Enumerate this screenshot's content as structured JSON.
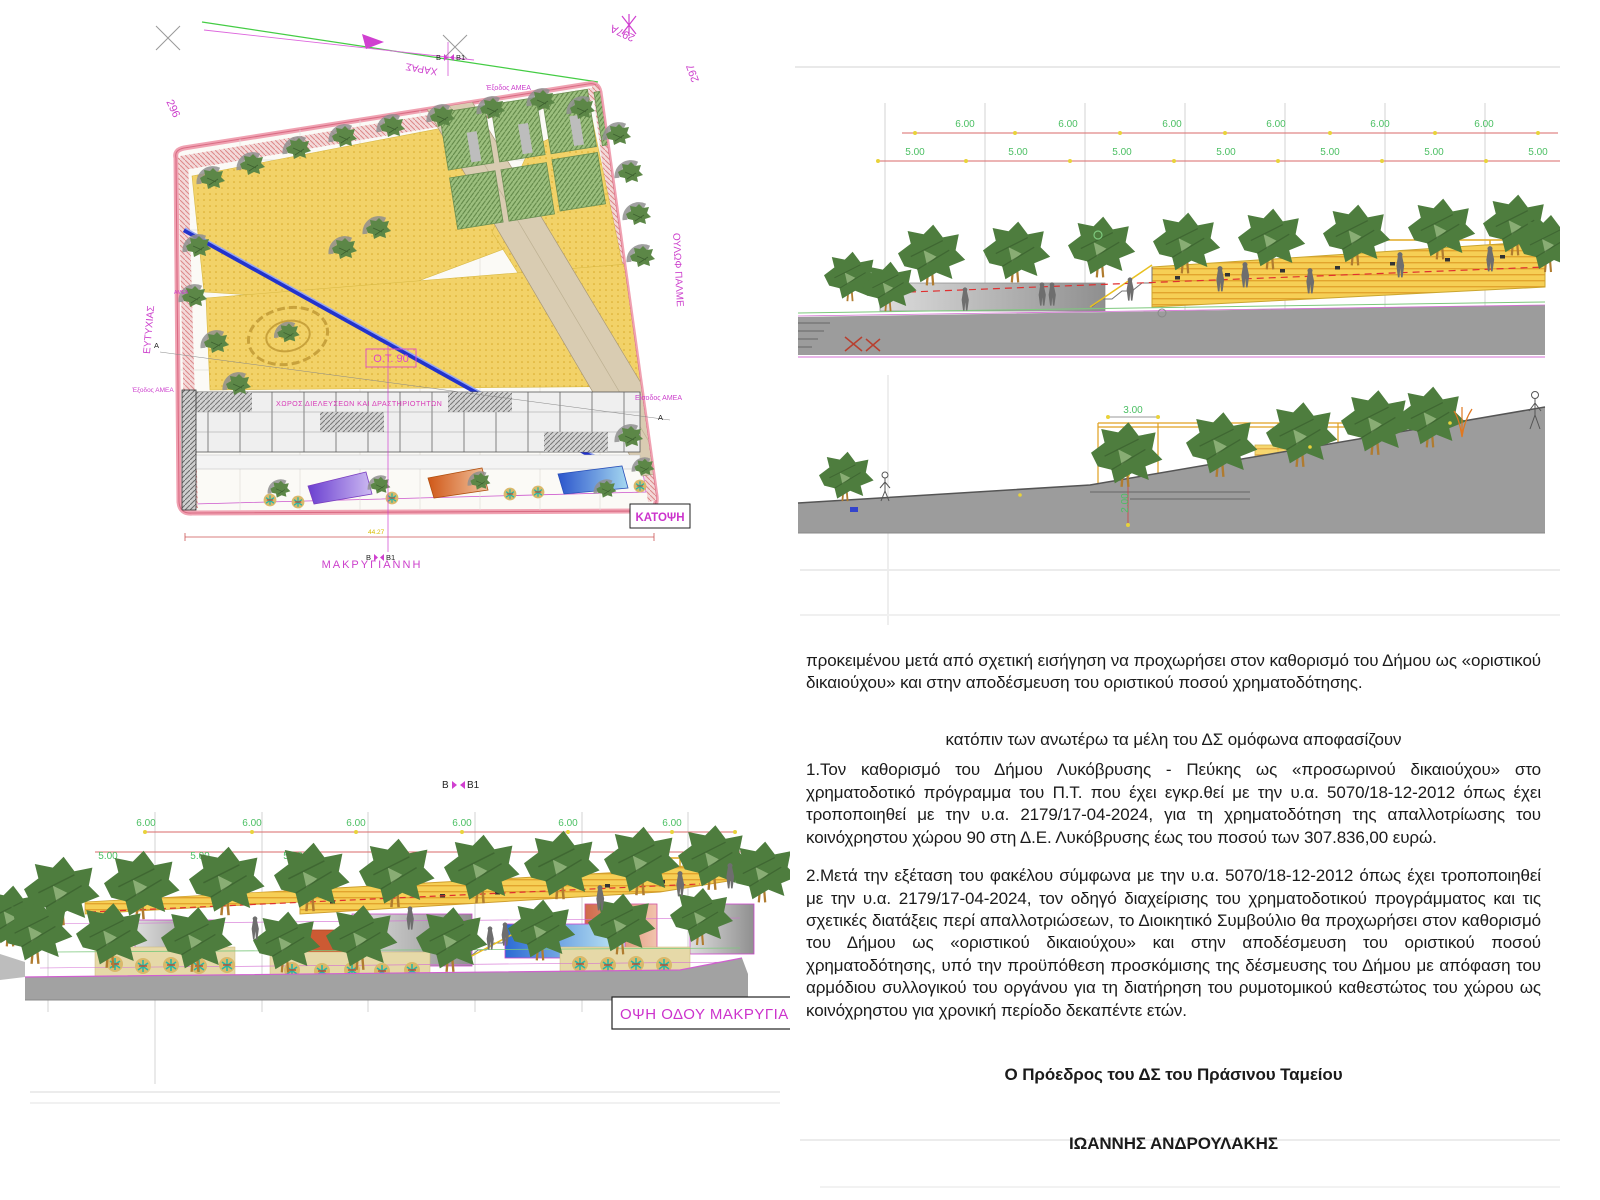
{
  "site_plan": {
    "title_box": "ΚΑΤΟΨΗ",
    "streets": {
      "top": "ΧΑΡΑΣ",
      "left": "ΕΥΤΥΧΙΑΣ",
      "right": "ΟΥΛΩΦ ΠΑΛΜΕ",
      "bottom": "ΜΑΚΡΥΓΙΑΝΝΗ"
    },
    "blocks": {
      "a": "297Α",
      "b": "297",
      "c": "296"
    },
    "ot_label": "Ο.Τ.  90",
    "area_label": "ΧΩΡΟΣ ΔΙΕΛΕΥΣΕΩΝ ΚΑΙ ΔΡΑΣΤΗΡΙΟΤΗΤΩΝ",
    "amea_exit_top": "Έξοδος ΑΜΕΑ",
    "amea_exit_left": "Έξοδος ΑΜΕΑ",
    "amea_entry_right": "Είσοδος ΑΜΕΑ",
    "amea_short": "ΑΜΕΑ",
    "marker_b": "Β",
    "marker_b1": "Β1",
    "marker_a": "Α",
    "dim_total": "44.27"
  },
  "sections_right": {
    "upper": {
      "dims_6m": [
        "6.00",
        "6.00",
        "6.00",
        "6.00",
        "6.00",
        "6.00"
      ],
      "dims_5m": [
        "5.00",
        "5.00",
        "5.00",
        "5.00",
        "5.00",
        "5.00",
        "5.00"
      ]
    },
    "lower": {
      "dim_width": "3.00",
      "dim_height": "2.00"
    }
  },
  "elevation_bottom": {
    "marker_b": "Β",
    "marker_b1": "Β1",
    "dims_6m": [
      "6.00",
      "6.00",
      "6.00",
      "6.00",
      "6.00",
      "6.00"
    ],
    "dims_5m": [
      "5.00",
      "5.00",
      "5.00",
      "5.00",
      "5.00",
      "5.00",
      "5.00",
      "5.00"
    ],
    "title_box": "ΟΨΗ ΟΔΟΥ ΜΑΚΡΥΓΙΑΝ"
  },
  "decision": {
    "intro": "προκειμένου μετά από σχετική εισήγηση να προχωρήσει στον καθορισμό του Δήμου ως «οριστικού δικαιούχου» και στην αποδέσμευση του οριστικού ποσού χρηματοδότησης.",
    "heading": "κατόπιν των ανωτέρω τα μέλη του ΔΣ ομόφωνα αποφασίζουν",
    "item1": "1.Τον καθορισμό του Δήμου Λυκόβρυσης - Πεύκης ως «προσωρινού δικαιούχου» στο χρηματοδοτικό πρόγραμμα του Π.Τ. που έχει εγκρ.θεί με την υ.α. 5070/18-12-2012 όπως έχει τροποποιηθεί με την υ.α. 2179/17-04-2024, για τη χρηματοδότηση της απαλλοτρίωσης του κοινόχρηστου χώρου 90 στη Δ.Ε. Λυκόβρυσης έως του ποσού των 307.836,00 ευρώ.",
    "item2": "2.Μετά την εξέταση του φακέλου σύμφωνα με την υ.α. 5070/18-12-2012 όπως έχει τροποποιηθεί με την υ.α. 2179/17-04-2024, τον οδηγό διαχείρισης του χρηματοδοτικού προγράμματος και τις σχετικές διατάξεις περί απαλλοτριώσεων, το Διοικητικό Συμβούλιο θα προχωρήσει στον καθορισμό του Δήμου ως «οριστικού δικαιούχου» και στην αποδέσμευση του οριστικού ποσού χρηματοδότησης, υπό την προϋπόθεση προσκόμισης της δέσμευσης του Δήμου με απόφαση του αρμόδιου συλλογικού του οργάνου για τη διατήρηση του ρυμοτομικού καθεστώτος του χώρου ως κοινόχρηστου για χρονική περίοδο δεκαπέντε ετών.",
    "signature_role": "Ο Πρόεδρος του ΔΣ του Πράσινου Ταμείου",
    "signature_name": "ΙΩΑΝΝΗΣ ΑΝΔΡΟΥΛΑΚΗΣ"
  },
  "colors": {
    "magenta": "#cc3fcc",
    "dim_green": "#4bbf63",
    "dim_red": "#d96a6a",
    "plaza_yellow": "#f2cf5e",
    "tree_green": "#4e7d3e",
    "ground_gray": "#9c9c9c",
    "path_tan": "#d9ccb2",
    "water_blue": "#2233cc"
  }
}
